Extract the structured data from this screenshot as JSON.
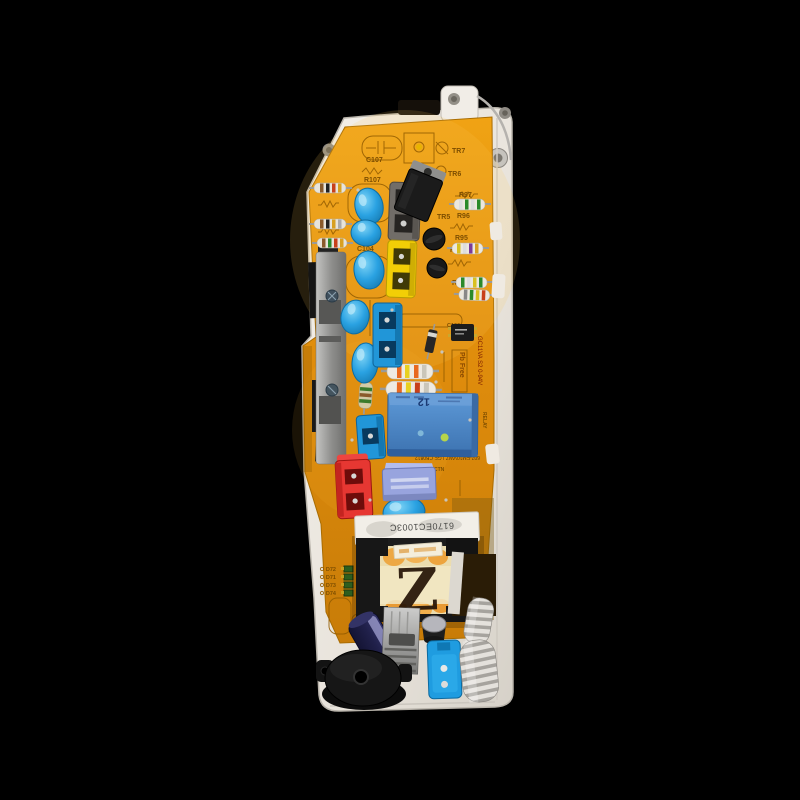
{
  "scene": {
    "type": "photograph",
    "subject": "Washing machine control PCB in white plastic housing",
    "background_color": "#000000",
    "pcb_color": "#e0900e",
    "case_color": "#ece7df"
  },
  "silkscreen": {
    "c107": "C107",
    "r107": "R107",
    "tr7": "TR7",
    "tr6": "TR6",
    "tr5": "TR5",
    "r97": "R97",
    "r96": "R96",
    "r95": "R95",
    "r94": "R94",
    "r93": "R93",
    "r105": "R105",
    "r104": "R104",
    "r103": "R103",
    "c104": "C104",
    "c100": "C100",
    "ctn": "CTN",
    "relay_text": "RELAY",
    "pb_free": "Pb Free",
    "board_marking": "GC11VA S2 0-94V",
    "relay_footprint": "607-EM10VWZ LGE CB0812",
    "d_labels": [
      "D72",
      "D71",
      "D73",
      "D74"
    ]
  },
  "components": {
    "relay_marking": "12",
    "transformer_label": "6170EC1003C",
    "handwritten_mark": "Z"
  }
}
